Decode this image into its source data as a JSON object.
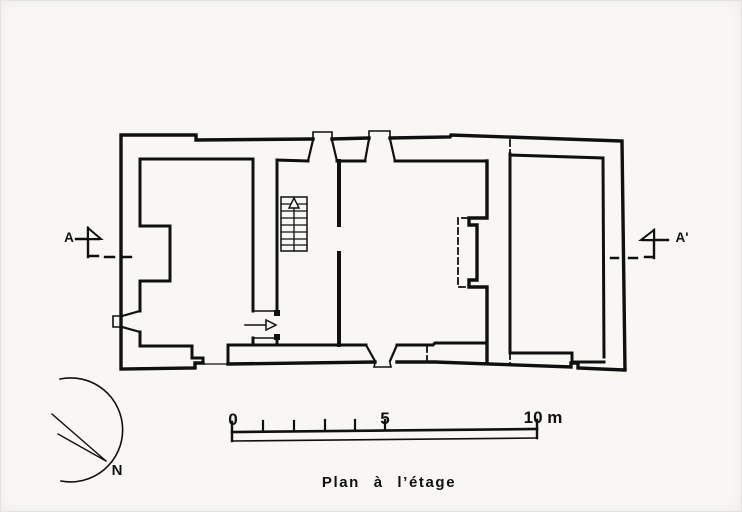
{
  "colors": {
    "paper": "#f8f7f4",
    "ink": "#101010"
  },
  "section": {
    "left_label": "A",
    "right_label": "A'"
  },
  "compass": {
    "north_label": "N"
  },
  "scale_bar": {
    "label_start": "0",
    "label_mid": "5",
    "label_end": "10 m"
  },
  "caption": {
    "text": "Plan à l’étage"
  }
}
